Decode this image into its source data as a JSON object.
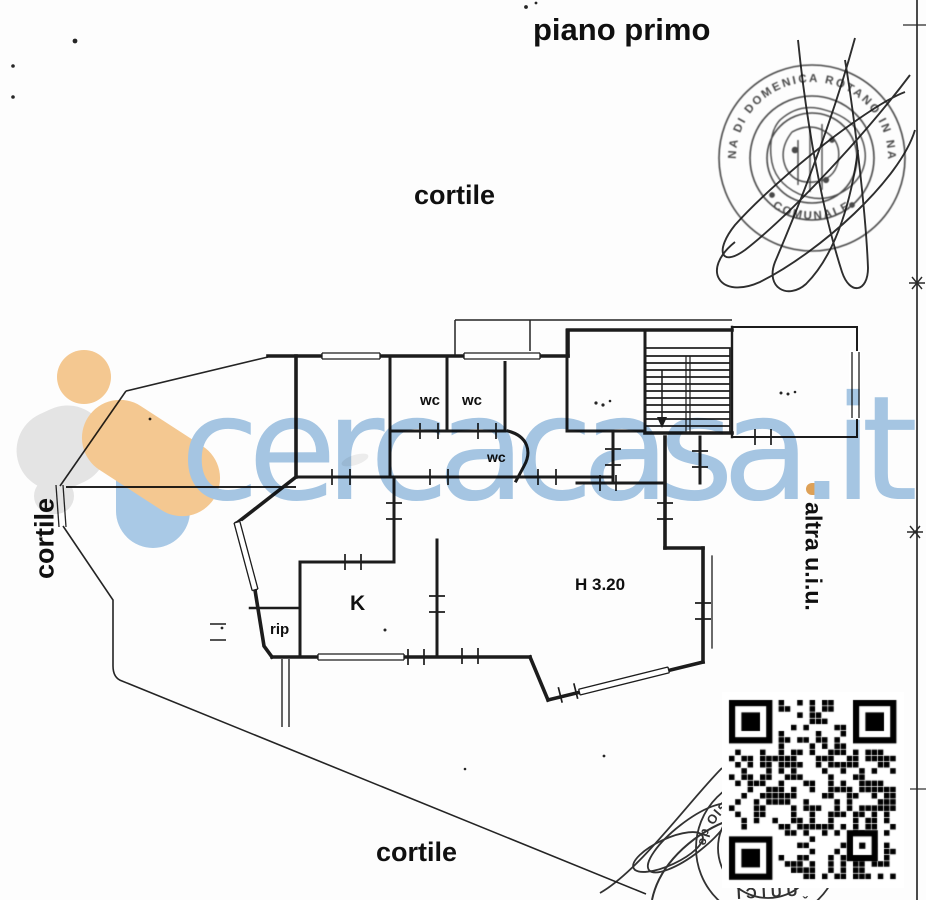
{
  "page": {
    "floor_title": "piano primo"
  },
  "courtyard": {
    "top": "cortile",
    "left": "cortile",
    "bottom": "cortile"
  },
  "side_note": {
    "other_unit": "altra u.i.u."
  },
  "rooms": {
    "wc_a": "wc",
    "wc_b": "wc",
    "wc_c": "wc",
    "kitchen": "K",
    "storage": "rip",
    "height": "H 3.20"
  },
  "watermark": {
    "brand": "cercacasa.it"
  },
  "stamps": {
    "notary_ring_top": "MARINA DI DOMENICA ROTANO IN NAPOLI",
    "notary_ring_bottom": "COMUNALE",
    "bottom_arc_fragment": "GIO de",
    "bottom_base_fragment": "IƆIUUˬ"
  },
  "colors": {
    "watermark_blue": "#a6c7e4",
    "logo_orange": "#f6ca92",
    "logo_blue": "#abcbe8",
    "logo_gray": "#e6e6e6",
    "ink": "#1c1c1c"
  }
}
